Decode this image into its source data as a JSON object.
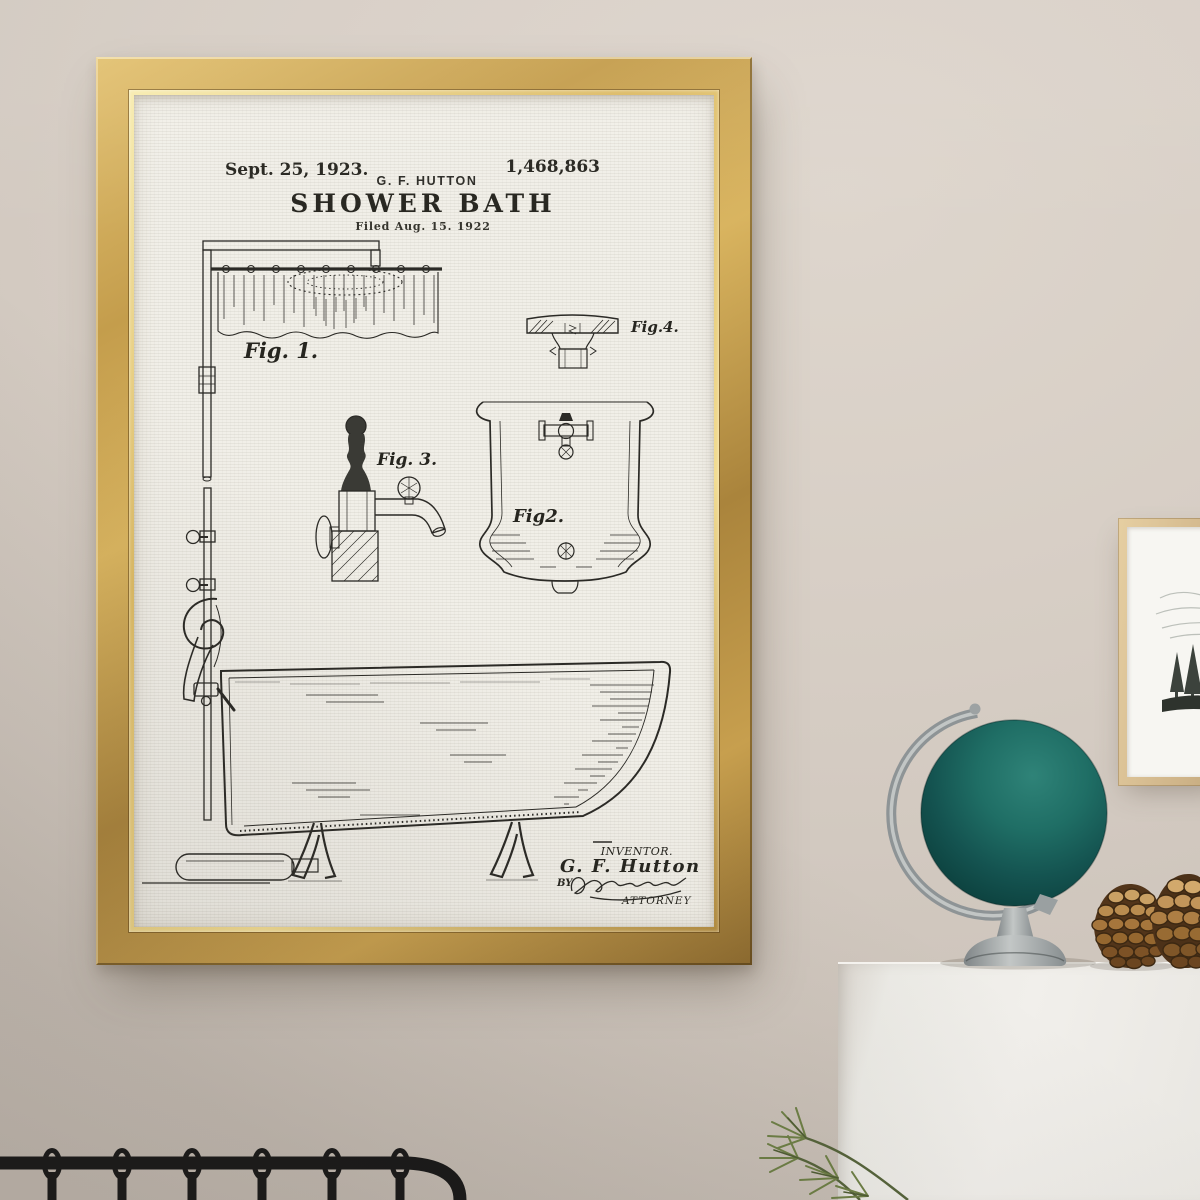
{
  "scene": {
    "objects": [
      "patent-poster",
      "gold-frame",
      "side-picture-frame",
      "forest-sketch",
      "teal-globe",
      "pinecones",
      "white-dresser",
      "pine-sprig",
      "metal-bed-headboard"
    ]
  },
  "poster": {
    "header": {
      "date": "Sept. 25, 1923.",
      "inventor": "G. F. HUTTON",
      "number": "1,468,863",
      "title": "SHOWER BATH",
      "filed": "Filed Aug. 15. 1922"
    },
    "figures": {
      "fig1": "Fig. 1.",
      "fig2": "Fig2.",
      "fig3": "Fig. 3.",
      "fig4": "Fig.4."
    },
    "footer": {
      "inventor_label": "INVENTOR.",
      "inventor_name": "G. F. Hutton",
      "by_label": "BY",
      "attorney_label": "ATTORNEY"
    }
  },
  "colors": {
    "wall": "#d5ccc3",
    "frame_gold": "#c29c4c",
    "paper": "#f1efe8",
    "ink": "#2b2a26",
    "globe_teal": "#176058",
    "stand_silver": "#a3a8a9",
    "dresser_white": "#edebe6",
    "pinecone_brown": "#a5713a",
    "pine_green": "#67793f",
    "bed_black": "#181818",
    "side_frame_wood": "#d9c198"
  }
}
